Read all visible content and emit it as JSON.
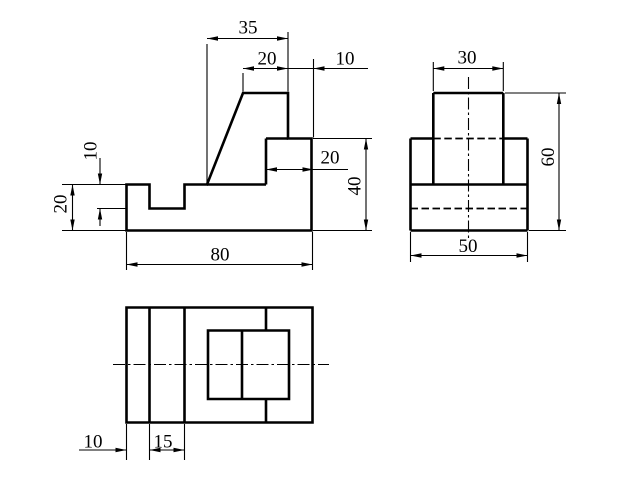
{
  "canvas": {
    "width": 640,
    "height": 480,
    "background": "#ffffff",
    "line_color": "#000000"
  },
  "labels": {
    "front_35": "35",
    "front_20_top": "20",
    "front_10_top": "10",
    "front_20_step": "20",
    "front_40": "40",
    "front_10_left": "10",
    "front_20_left": "20",
    "front_80": "80",
    "side_30": "30",
    "side_60": "60",
    "side_50": "50",
    "top_10": "10",
    "top_15": "15"
  },
  "views": {
    "front": {
      "thick": [
        {
          "c": 1,
          "p": [
            [
              126.5,
              230.5
            ],
            [
              126.5,
              184.5
            ],
            [
              149.5,
              184.5
            ],
            [
              149.5,
              208.5
            ],
            [
              184.5,
              208.5
            ],
            [
              184.5,
              184.5
            ],
            [
              207,
              184.5
            ],
            [
              243,
              93
            ],
            [
              288,
              93
            ],
            [
              288,
              138.5
            ],
            [
              311.5,
              138.5
            ],
            [
              311.5,
              230.5
            ]
          ]
        },
        [
          [
            266,
            138.5
          ],
          [
            288,
            138.5
          ]
        ],
        [
          [
            266,
            138.5
          ],
          [
            266,
            184.5
          ]
        ],
        [
          [
            207,
            184.5
          ],
          [
            266,
            184.5
          ]
        ]
      ],
      "thin": [
        [
          [
            207,
            44
          ],
          [
            207,
            183
          ]
        ],
        [
          [
            288,
            32
          ],
          [
            288,
            91.5
          ]
        ],
        [
          [
            243,
            73
          ],
          [
            243,
            91.5
          ]
        ],
        [
          [
            313.5,
            59
          ],
          [
            313.5,
            137.5
          ]
        ],
        [
          [
            207,
            38.5
          ],
          [
            288,
            38.5
          ]
        ],
        [
          [
            243,
            68.5
          ],
          [
            288,
            68.5
          ]
        ],
        [
          [
            288,
            68.5
          ],
          [
            368,
            68.5
          ]
        ],
        [
          [
            266,
            169.5
          ],
          [
            348,
            169.5
          ]
        ],
        [
          [
            313,
            138.5
          ],
          [
            372,
            138.5
          ]
        ],
        [
          [
            313,
            230.5
          ],
          [
            372,
            230.5
          ]
        ],
        [
          [
            366,
            138.5
          ],
          [
            366,
            230.5
          ]
        ],
        [
          [
            62,
            184.5
          ],
          [
            126.5,
            184.5
          ]
        ],
        [
          [
            97,
            208.5
          ],
          [
            126.5,
            208.5
          ]
        ],
        [
          [
            62,
            230.5
          ],
          [
            126.5,
            230.5
          ]
        ],
        [
          [
            100,
            158
          ],
          [
            100,
            184.5
          ]
        ],
        [
          [
            100,
            208.5
          ],
          [
            100,
            226
          ]
        ],
        [
          [
            72.5,
            184.5
          ],
          [
            72.5,
            230.5
          ]
        ],
        [
          [
            126.5,
            232
          ],
          [
            126.5,
            270
          ]
        ],
        [
          [
            312.5,
            232
          ],
          [
            312.5,
            270
          ]
        ],
        [
          [
            126.5,
            264.5
          ],
          [
            312.5,
            264.5
          ]
        ]
      ],
      "hidden": [],
      "center": [],
      "arrows": [
        [
          207,
          38.5,
          "left"
        ],
        [
          288,
          38.5,
          "right"
        ],
        [
          243,
          68.5,
          "left"
        ],
        [
          288,
          68.5,
          "right"
        ],
        [
          313.5,
          68.5,
          "left"
        ],
        [
          266,
          169.5,
          "left"
        ],
        [
          313.5,
          169.5,
          "right"
        ],
        [
          366,
          138.5,
          "up"
        ],
        [
          366,
          230.5,
          "down"
        ],
        [
          100,
          184.5,
          "down"
        ],
        [
          100,
          208.5,
          "up"
        ],
        [
          72.5,
          184.5,
          "up"
        ],
        [
          72.5,
          230.5,
          "down"
        ],
        [
          126.5,
          264.5,
          "left"
        ],
        [
          312.5,
          264.5,
          "right"
        ]
      ],
      "labels": [
        {
          "bind": "labels.front_35",
          "name": "dim-label-front-35",
          "x": 248,
          "y": 28,
          "rot": 0
        },
        {
          "bind": "labels.front_20_top",
          "name": "dim-label-front-20-top",
          "x": 267,
          "y": 59,
          "rot": 0
        },
        {
          "bind": "labels.front_10_top",
          "name": "dim-label-front-10-top",
          "x": 345,
          "y": 59,
          "rot": 0
        },
        {
          "bind": "labels.front_20_step",
          "name": "dim-label-front-20-step",
          "x": 330,
          "y": 158,
          "rot": 0
        },
        {
          "bind": "labels.front_40",
          "name": "dim-label-front-40",
          "x": 355,
          "y": 186,
          "rot": -90
        },
        {
          "bind": "labels.front_10_left",
          "name": "dim-label-front-10-left",
          "x": 91,
          "y": 151,
          "rot": -90
        },
        {
          "bind": "labels.front_20_left",
          "name": "dim-label-front-20-left",
          "x": 61,
          "y": 204,
          "rot": -90
        },
        {
          "bind": "labels.front_80",
          "name": "dim-label-front-80",
          "x": 220,
          "y": 255,
          "rot": 0
        }
      ]
    },
    "side": {
      "thick": [
        [
          [
            433.3,
            93
          ],
          [
            503.3,
            93
          ]
        ],
        [
          [
            433.3,
            93
          ],
          [
            433.3,
            184.5
          ]
        ],
        [
          [
            503.3,
            93
          ],
          [
            503.3,
            184.5
          ]
        ],
        [
          [
            410.5,
            138.5
          ],
          [
            433.3,
            138.5
          ]
        ],
        [
          [
            503.3,
            138.5
          ],
          [
            527.5,
            138.5
          ]
        ],
        [
          [
            410.5,
            138.5
          ],
          [
            410.5,
            230.5
          ]
        ],
        [
          [
            527.5,
            138.5
          ],
          [
            527.5,
            230.5
          ]
        ],
        [
          [
            410.5,
            184.5
          ],
          [
            527.5,
            184.5
          ]
        ],
        [
          [
            410.5,
            230.5
          ],
          [
            527.5,
            230.5
          ]
        ]
      ],
      "thin": [
        [
          [
            433.3,
            62
          ],
          [
            433.3,
            91
          ]
        ],
        [
          [
            503.3,
            62
          ],
          [
            503.3,
            91
          ]
        ],
        [
          [
            433.3,
            68.5
          ],
          [
            503.3,
            68.5
          ]
        ],
        [
          [
            505,
            93
          ],
          [
            566,
            93
          ]
        ],
        [
          [
            529,
            230.5
          ],
          [
            566,
            230.5
          ]
        ],
        [
          [
            559,
            93
          ],
          [
            559,
            230.5
          ]
        ],
        [
          [
            410.5,
            232
          ],
          [
            410.5,
            262
          ]
        ],
        [
          [
            527.5,
            232
          ],
          [
            527.5,
            262
          ]
        ],
        [
          [
            410.5,
            255.5
          ],
          [
            527.5,
            255.5
          ]
        ]
      ],
      "hidden": [
        [
          [
            433.3,
            138.5
          ],
          [
            503.3,
            138.5
          ]
        ],
        [
          [
            410.5,
            208.5
          ],
          [
            527.5,
            208.5
          ]
        ]
      ],
      "center": [
        [
          [
            468.5,
            77
          ],
          [
            468.5,
            241
          ]
        ]
      ],
      "arrows": [
        [
          433.3,
          68.5,
          "left"
        ],
        [
          503.3,
          68.5,
          "right"
        ],
        [
          559,
          93,
          "up"
        ],
        [
          559,
          230.5,
          "down"
        ],
        [
          410.5,
          255.5,
          "left"
        ],
        [
          527.5,
          255.5,
          "right"
        ]
      ],
      "labels": [
        {
          "bind": "labels.side_30",
          "name": "dim-label-side-30",
          "x": 467,
          "y": 58,
          "rot": 0
        },
        {
          "bind": "labels.side_60",
          "name": "dim-label-side-60",
          "x": 548.5,
          "y": 157,
          "rot": -90
        },
        {
          "bind": "labels.side_50",
          "name": "dim-label-side-50",
          "x": 468,
          "y": 246.5,
          "rot": 0
        }
      ]
    },
    "top": {
      "thick": [
        {
          "c": 1,
          "p": [
            [
              126.5,
              307.5
            ],
            [
              312.5,
              307.5
            ],
            [
              312.5,
              422.5
            ],
            [
              126.5,
              422.5
            ]
          ]
        },
        [
          [
            149.5,
            307.5
          ],
          [
            149.5,
            422.5
          ]
        ],
        [
          [
            184.5,
            307.5
          ],
          [
            184.5,
            422.5
          ]
        ],
        {
          "c": 1,
          "p": [
            [
              208,
              330.5
            ],
            [
              289,
              330.5
            ],
            [
              289,
              399
            ],
            [
              208,
              399
            ]
          ]
        },
        [
          [
            242,
            330.5
          ],
          [
            242,
            399
          ]
        ],
        [
          [
            266,
            307.5
          ],
          [
            266,
            330.5
          ]
        ],
        [
          [
            266,
            399
          ],
          [
            266,
            422.5
          ]
        ]
      ],
      "thin": [
        [
          [
            126.5,
            424
          ],
          [
            126.5,
            460
          ]
        ],
        [
          [
            149.5,
            424
          ],
          [
            149.5,
            460
          ]
        ],
        [
          [
            184.5,
            424
          ],
          [
            184.5,
            460
          ]
        ],
        [
          [
            79,
            450
          ],
          [
            126.5,
            450
          ]
        ],
        [
          [
            149.5,
            450
          ],
          [
            184.5,
            450
          ]
        ]
      ],
      "hidden": [],
      "center": [
        [
          [
            113,
            364.5
          ],
          [
            329,
            364.5
          ]
        ]
      ],
      "arrows": [
        [
          126.5,
          450,
          "right"
        ],
        [
          149.5,
          450,
          "left"
        ],
        [
          184.5,
          450,
          "right"
        ]
      ],
      "labels": [
        {
          "bind": "labels.top_10",
          "name": "dim-label-top-10",
          "x": 93,
          "y": 442,
          "rot": 0
        },
        {
          "bind": "labels.top_15",
          "name": "dim-label-top-15",
          "x": 163,
          "y": 442,
          "rot": 0
        }
      ]
    }
  }
}
